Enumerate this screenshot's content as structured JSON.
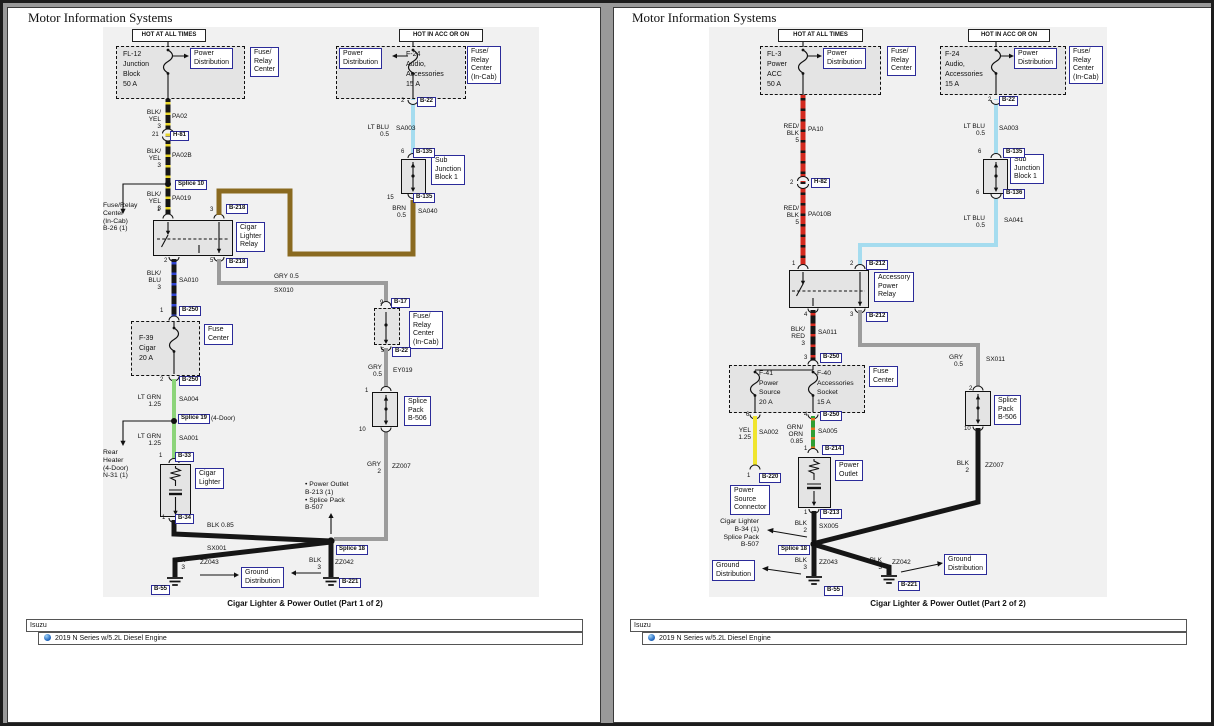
{
  "header": {
    "title": "Motor Information Systems"
  },
  "footer": {
    "brand": "Isuzu",
    "vehicle": "2019 N Series w/5.2L Diesel Engine"
  },
  "banners": {
    "hot_all": "HOT AT ALL TIMES",
    "hot_acc": "HOT IN ACC OR ON"
  },
  "captions": {
    "p1": "Cigar Lighter & Power Outlet (Part 1 of 2)",
    "p2": "Cigar Lighter & Power Outlet (Part 2 of 2)"
  },
  "comp": {
    "power_dist": "Power\nDistribution",
    "frc": "Fuse/\nRelay\nCenter",
    "frc_incab": "Fuse/\nRelay\nCenter\n(In-Cab)",
    "fuse_center": "Fuse\nCenter",
    "subj": "Sub\nJunction\nBlock 1",
    "sp_b506": "Splice\nPack\nB-506",
    "ground_dist": "Ground\nDistribution",
    "cigar_relay": "Cigar\nLighter\nRelay",
    "acc_relay": "Accessory\nPower\nRelay",
    "cigar_lighter": "Cigar\nLighter",
    "power_outlet": "Power\nOutlet",
    "psc": "Power\nSource\nConnector",
    "fl12": "FL-12\nJunction\nBlock\n50 A",
    "fl3": "FL-3\nPower\nACC\n50 A",
    "f24": "F-24\nAudio,\nAccessories\n15 A",
    "f39": "F-39\nCigar\n20 A",
    "f41": "F-41\nPower\nSource\n20 A",
    "f40": "F-40\nAccessories\nSocket\n15 A"
  },
  "tags": {
    "b17": "B-17",
    "b22": "B-22",
    "b33": "B-33",
    "b34": "B-34",
    "b55": "B-55",
    "b135": "B-135",
    "b136": "B-136",
    "b212": "B-212",
    "b213": "B-213",
    "b214": "B-214",
    "b218": "B-218",
    "b220": "B-220",
    "b221": "B-221",
    "b250": "B-250",
    "h81": "H-81",
    "h82": "H-82",
    "splice10": "Splice 10",
    "splice18": "Splice 18",
    "splice19": "Splice 19"
  },
  "pins": {
    "p1": "1",
    "p2": "2",
    "p3": "3",
    "p4": "4",
    "p5": "5",
    "p6": "6",
    "p9": "9",
    "p10": "10",
    "p15": "15",
    "p21": "21"
  },
  "wires": {
    "blkyel3": "BLK/\nYEL\n3",
    "redblk5": "RED/\nBLK\n5",
    "blkblu3": "BLK/\nBLU\n3",
    "blkred3": "BLK/\nRED\n3",
    "grnorn085": "GRN/\nORN\n0.85",
    "ltgrn125": "LT GRN\n1.25",
    "ltblu05": "LT BLU\n0.5",
    "brn05": "BRN\n0.5",
    "gry05": "GRY 0.5",
    "gry05v": "GRY\n0.5",
    "gry2": "GRY\n2",
    "blk2": "BLK\n2",
    "blk3": "BLK\n3",
    "yel125": "YEL\n1.25",
    "blk085": "BLK 0.85",
    "pa02": "PA02",
    "pa02b": "PA02B",
    "pa019": "PA019",
    "pa10": "PA10",
    "pa010b": "PA010B",
    "sa001": "SA001",
    "sa002": "SA002",
    "sa003": "SA003",
    "sa004": "SA004",
    "sa005": "SA005",
    "sa010": "SA010",
    "sa011": "SA011",
    "sa040": "SA040",
    "sa041": "SA041",
    "sx001": "SX001",
    "sx005": "SX005",
    "sx010": "SX010",
    "sx011": "SX011",
    "ey019": "EY019",
    "zz007": "ZZ007",
    "zz042": "ZZ042",
    "zz043": "ZZ043"
  },
  "notes": {
    "b26": "Fuse/Relay\nCenter\n(In-Cab)\nB-26 (1)",
    "rear_heater": "Rear\nHeater\n(4-Door)\nN-31 (1)",
    "four_door": "(4-Door)",
    "outlet_splice": "• Power Outlet\n   B-213 (1)\n• Splice Pack\n   B-507",
    "cigar_splice": "Cigar Lighter\nB-34 (1)\nSplice Pack\nB-507"
  },
  "colors": {
    "wire_black": "#161616",
    "wire_red": "#d3291e",
    "wire_yellow": "#f0e52e",
    "wire_lt_green": "#8cd47a",
    "wire_lt_blue": "#a5dcef",
    "wire_brown": "#8a6a20",
    "wire_gray": "#9c9c9c",
    "wire_green": "#2f9e33",
    "wire_orange": "#e0761f",
    "wire_blue_stripe": "#2f42cf",
    "tag_border": "#2b2b99",
    "canvas": "#f1f1f1"
  }
}
